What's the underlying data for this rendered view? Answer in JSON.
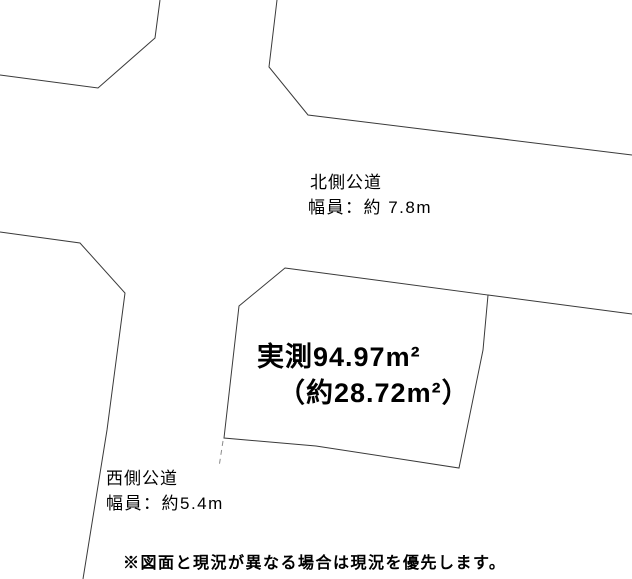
{
  "colors": {
    "background": "#ffffff",
    "line": "#3a3a3a",
    "faint_line": "#8a8a8a",
    "text": "#000000"
  },
  "labels": {
    "north_road": {
      "line1": "北側公道",
      "line2": "幅員：約 7.8m"
    },
    "west_road": {
      "line1": "西側公道",
      "line2": "幅員：約5.4m"
    },
    "parcel": {
      "line1": "実測94.97m²",
      "line2": "（約28.72m²）"
    },
    "disclaimer": "※図面と現況が異なる場合は現況を優先します。"
  },
  "diagram": {
    "width": 632,
    "height": 579,
    "parcel": {
      "name": "parcel-outline",
      "points": "285,268 488,295 483,350 459,468 316,446 224,438 239,306"
    },
    "polylines": [
      {
        "name": "northwest-block-boundary",
        "points": "0,75 98,88 155,38 160,0",
        "dashed": false
      },
      {
        "name": "northeast-block-boundary",
        "points": "277,0 269,67 308,115 632,155",
        "dashed": false
      },
      {
        "name": "southwest-block-boundary",
        "points": "0,232 80,243 125,293 107,430 83,579",
        "dashed": false
      },
      {
        "name": "north-road-south-edge",
        "points": "488,295 632,314",
        "dashed": false
      },
      {
        "name": "west-road-east-edge-extension",
        "points": "223,441 219,467",
        "dashed": true
      }
    ]
  }
}
